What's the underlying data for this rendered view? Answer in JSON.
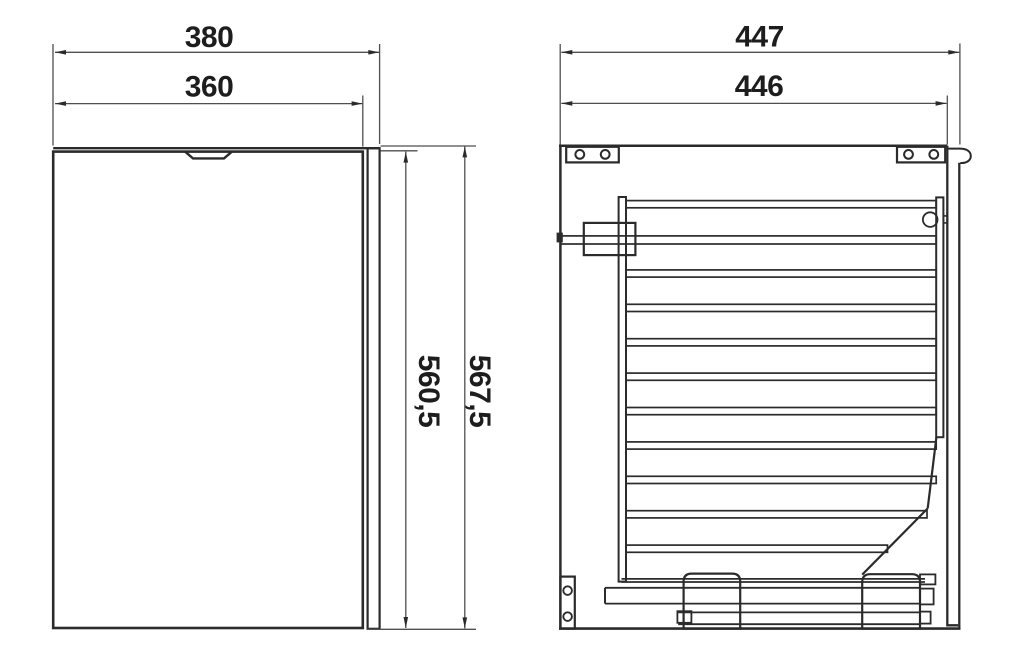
{
  "page": {
    "background_color": "#ffffff"
  },
  "drawing": {
    "description": "Two-view technical dimension drawing of a cabinet pull-out unit (front door view and side section view)",
    "colors": {
      "object_line": "#2b2b2b",
      "dimension_line": "#4f4f4f",
      "text": "#1d1d1d"
    },
    "front_view": {
      "width_outer_mm": "380",
      "width_inner_mm": "360",
      "height_inner_mm": "560,5",
      "height_outer_mm": "567,5"
    },
    "side_view": {
      "depth_outer_mm": "447",
      "depth_inner_mm": "446"
    }
  }
}
